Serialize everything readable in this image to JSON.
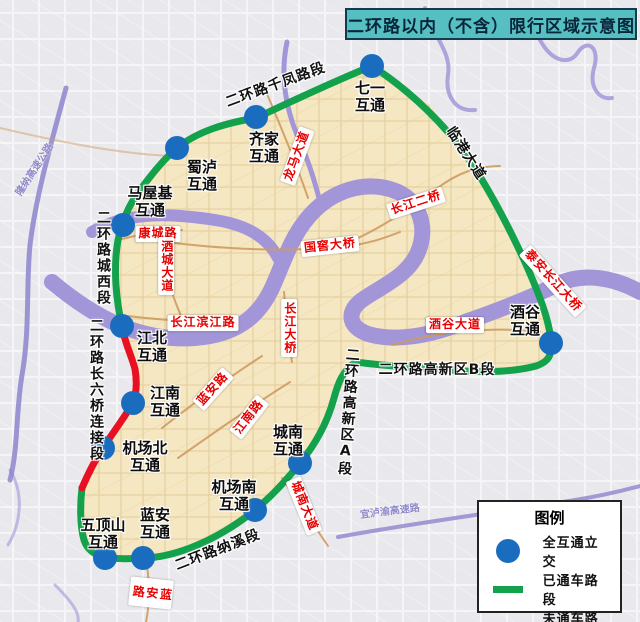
{
  "title": "二环路以内（不含）限行区域示意图",
  "map": {
    "interchanges": [
      {
        "name": "七一互通",
        "label": "七一\n互通"
      },
      {
        "name": "齐家互通",
        "label": "齐家\n互通"
      },
      {
        "name": "蜀泸互通",
        "label": "蜀泸\n互通"
      },
      {
        "name": "马屋基互通",
        "label": "马屋基\n互通"
      },
      {
        "name": "江北互通",
        "label": "江北\n互通"
      },
      {
        "name": "江南互通",
        "label": "江南\n互通"
      },
      {
        "name": "机场北互通",
        "label": "机场北\n互通"
      },
      {
        "name": "五顶山互通",
        "label": "五顶山\n互通"
      },
      {
        "name": "蓝安互通",
        "label": "蓝安\n互通"
      },
      {
        "name": "机场南互通",
        "label": "机场南\n互通"
      },
      {
        "name": "城南互通",
        "label": "城南\n互通"
      },
      {
        "name": "酒谷互通",
        "label": "酒谷\n互通"
      }
    ],
    "ring_sections": [
      "二环路千凤路段",
      "临港大道",
      "二环路高新区B段",
      "二环路高新区A段",
      "二环路纳溪段",
      "二环路城西段",
      "二环路长六桥连接段"
    ],
    "roads_red": [
      "龙马大道",
      "康城路",
      "酒城大道",
      "长江滨江路",
      "国窖大桥",
      "长江二桥",
      "长江大桥",
      "酒谷大道",
      "城南大道",
      "蓝安路",
      "蓝安路",
      "江南路",
      "泰安长江大桥"
    ],
    "highways": [
      "隆纳高速公路",
      "宜泸渝高速路"
    ]
  },
  "legend": {
    "title": "图例",
    "items": [
      {
        "icon": "blue-dot",
        "label": "全互通立交"
      },
      {
        "icon": "green-line",
        "label": "已通车路段"
      },
      {
        "icon": "red-line",
        "label": "未通车路段"
      }
    ]
  },
  "colors": {
    "open_road": "#14a14c",
    "closed_road": "#e81123",
    "interchange_dot": "#1a6dbe",
    "river": "#a396d8",
    "zone_fill": "#f5e7c2",
    "title_bg": "#56bfc2"
  }
}
